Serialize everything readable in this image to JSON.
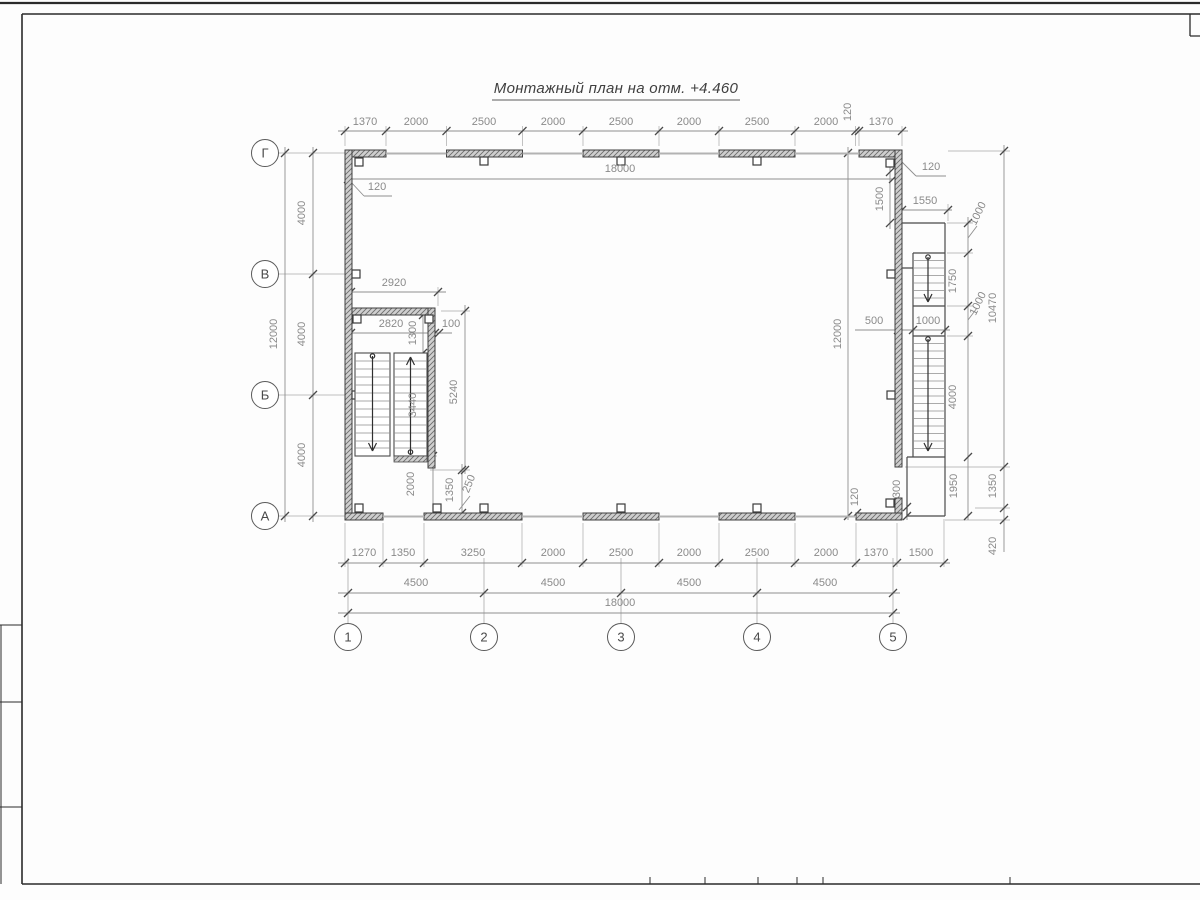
{
  "title": "Монтажный план на отм. +4.460",
  "colors": {
    "wall_line": "#3f3f3f",
    "wall_fill": "#cfcfcf",
    "dimension_line": "#8f8f8f",
    "dimension_text": "#8a8a8a",
    "window_line": "#b3b3b3"
  },
  "axes": {
    "vertical": [
      {
        "label": "Г",
        "cx": 265,
        "cy": 153
      },
      {
        "label": "В",
        "cx": 265,
        "cy": 274
      },
      {
        "label": "Б",
        "cx": 265,
        "cy": 395
      },
      {
        "label": "А",
        "cx": 265,
        "cy": 516
      }
    ],
    "horizontal": [
      {
        "label": "1",
        "cx": 348,
        "cy": 637
      },
      {
        "label": "2",
        "cx": 484,
        "cy": 637
      },
      {
        "label": "3",
        "cx": 621,
        "cy": 637
      },
      {
        "label": "4",
        "cx": 757,
        "cy": 637
      },
      {
        "label": "5",
        "cx": 893,
        "cy": 637
      }
    ]
  },
  "dimensions": [
    {
      "t": "1370",
      "x": 365,
      "y": 125,
      "r": 0
    },
    {
      "t": "2000",
      "x": 416,
      "y": 125,
      "r": 0
    },
    {
      "t": "2500",
      "x": 484,
      "y": 125,
      "r": 0
    },
    {
      "t": "2000",
      "x": 553,
      "y": 125,
      "r": 0
    },
    {
      "t": "2500",
      "x": 621,
      "y": 125,
      "r": 0
    },
    {
      "t": "2000",
      "x": 689,
      "y": 125,
      "r": 0
    },
    {
      "t": "2500",
      "x": 757,
      "y": 125,
      "r": 0
    },
    {
      "t": "2000",
      "x": 826,
      "y": 125,
      "r": 0
    },
    {
      "t": "120",
      "x": 851,
      "y": 112,
      "r": -90
    },
    {
      "t": "1370",
      "x": 881,
      "y": 125,
      "r": 0
    },
    {
      "t": "18000",
      "x": 620,
      "y": 172,
      "r": 0
    },
    {
      "t": "120",
      "x": 377,
      "y": 190,
      "r": 0
    },
    {
      "t": "4000",
      "x": 305,
      "y": 213,
      "r": -90
    },
    {
      "t": "4000",
      "x": 305,
      "y": 334,
      "r": -90
    },
    {
      "t": "4000",
      "x": 305,
      "y": 455,
      "r": -90
    },
    {
      "t": "12000",
      "x": 277,
      "y": 334,
      "r": -90
    },
    {
      "t": "2920",
      "x": 394,
      "y": 286,
      "r": 0
    },
    {
      "t": "2820",
      "x": 391,
      "y": 327,
      "r": 0
    },
    {
      "t": "100",
      "x": 451,
      "y": 327,
      "r": 0
    },
    {
      "t": "1300",
      "x": 416,
      "y": 333,
      "r": -90
    },
    {
      "t": "3440",
      "x": 416,
      "y": 405,
      "r": -90
    },
    {
      "t": "5240",
      "x": 457,
      "y": 392,
      "r": -90
    },
    {
      "t": "2000",
      "x": 414,
      "y": 484,
      "r": -90
    },
    {
      "t": "1350",
      "x": 453,
      "y": 490,
      "r": -90
    },
    {
      "t": "250",
      "x": 472,
      "y": 485,
      "r": -68
    },
    {
      "t": "1270",
      "x": 364,
      "y": 556,
      "r": 0
    },
    {
      "t": "1350",
      "x": 403,
      "y": 556,
      "r": 0
    },
    {
      "t": "3250",
      "x": 473,
      "y": 556,
      "r": 0
    },
    {
      "t": "2000",
      "x": 553,
      "y": 556,
      "r": 0
    },
    {
      "t": "2500",
      "x": 621,
      "y": 556,
      "r": 0
    },
    {
      "t": "2000",
      "x": 689,
      "y": 556,
      "r": 0
    },
    {
      "t": "2500",
      "x": 757,
      "y": 556,
      "r": 0
    },
    {
      "t": "2000",
      "x": 826,
      "y": 556,
      "r": 0
    },
    {
      "t": "1370",
      "x": 876,
      "y": 556,
      "r": 0
    },
    {
      "t": "1500",
      "x": 921,
      "y": 556,
      "r": 0
    },
    {
      "t": "4500",
      "x": 416,
      "y": 586,
      "r": 0
    },
    {
      "t": "4500",
      "x": 553,
      "y": 586,
      "r": 0
    },
    {
      "t": "4500",
      "x": 689,
      "y": 586,
      "r": 0
    },
    {
      "t": "4500",
      "x": 825,
      "y": 586,
      "r": 0
    },
    {
      "t": "18000",
      "x": 620,
      "y": 606,
      "r": 0
    },
    {
      "t": "120",
      "x": 858,
      "y": 497,
      "r": -90
    },
    {
      "t": "300",
      "x": 900,
      "y": 489,
      "r": -90
    },
    {
      "t": "1950",
      "x": 957,
      "y": 486,
      "r": -90
    },
    {
      "t": "1350",
      "x": 996,
      "y": 486,
      "r": -90
    },
    {
      "t": "420",
      "x": 996,
      "y": 546,
      "r": -90
    },
    {
      "t": "120",
      "x": 931,
      "y": 170,
      "r": 0
    },
    {
      "t": "1500",
      "x": 883,
      "y": 199,
      "r": -90
    },
    {
      "t": "1550",
      "x": 925,
      "y": 204,
      "r": 0
    },
    {
      "t": "1000",
      "x": 981,
      "y": 215,
      "r": -64
    },
    {
      "t": "1750",
      "x": 956,
      "y": 281,
      "r": -90
    },
    {
      "t": "1000",
      "x": 981,
      "y": 305,
      "r": -64
    },
    {
      "t": "500",
      "x": 874,
      "y": 324,
      "r": 0
    },
    {
      "t": "1000",
      "x": 928,
      "y": 324,
      "r": 0
    },
    {
      "t": "4000",
      "x": 956,
      "y": 397,
      "r": -90
    },
    {
      "t": "12000",
      "x": 841,
      "y": 334,
      "r": -90
    },
    {
      "t": "10470",
      "x": 996,
      "y": 308,
      "r": -90
    }
  ]
}
